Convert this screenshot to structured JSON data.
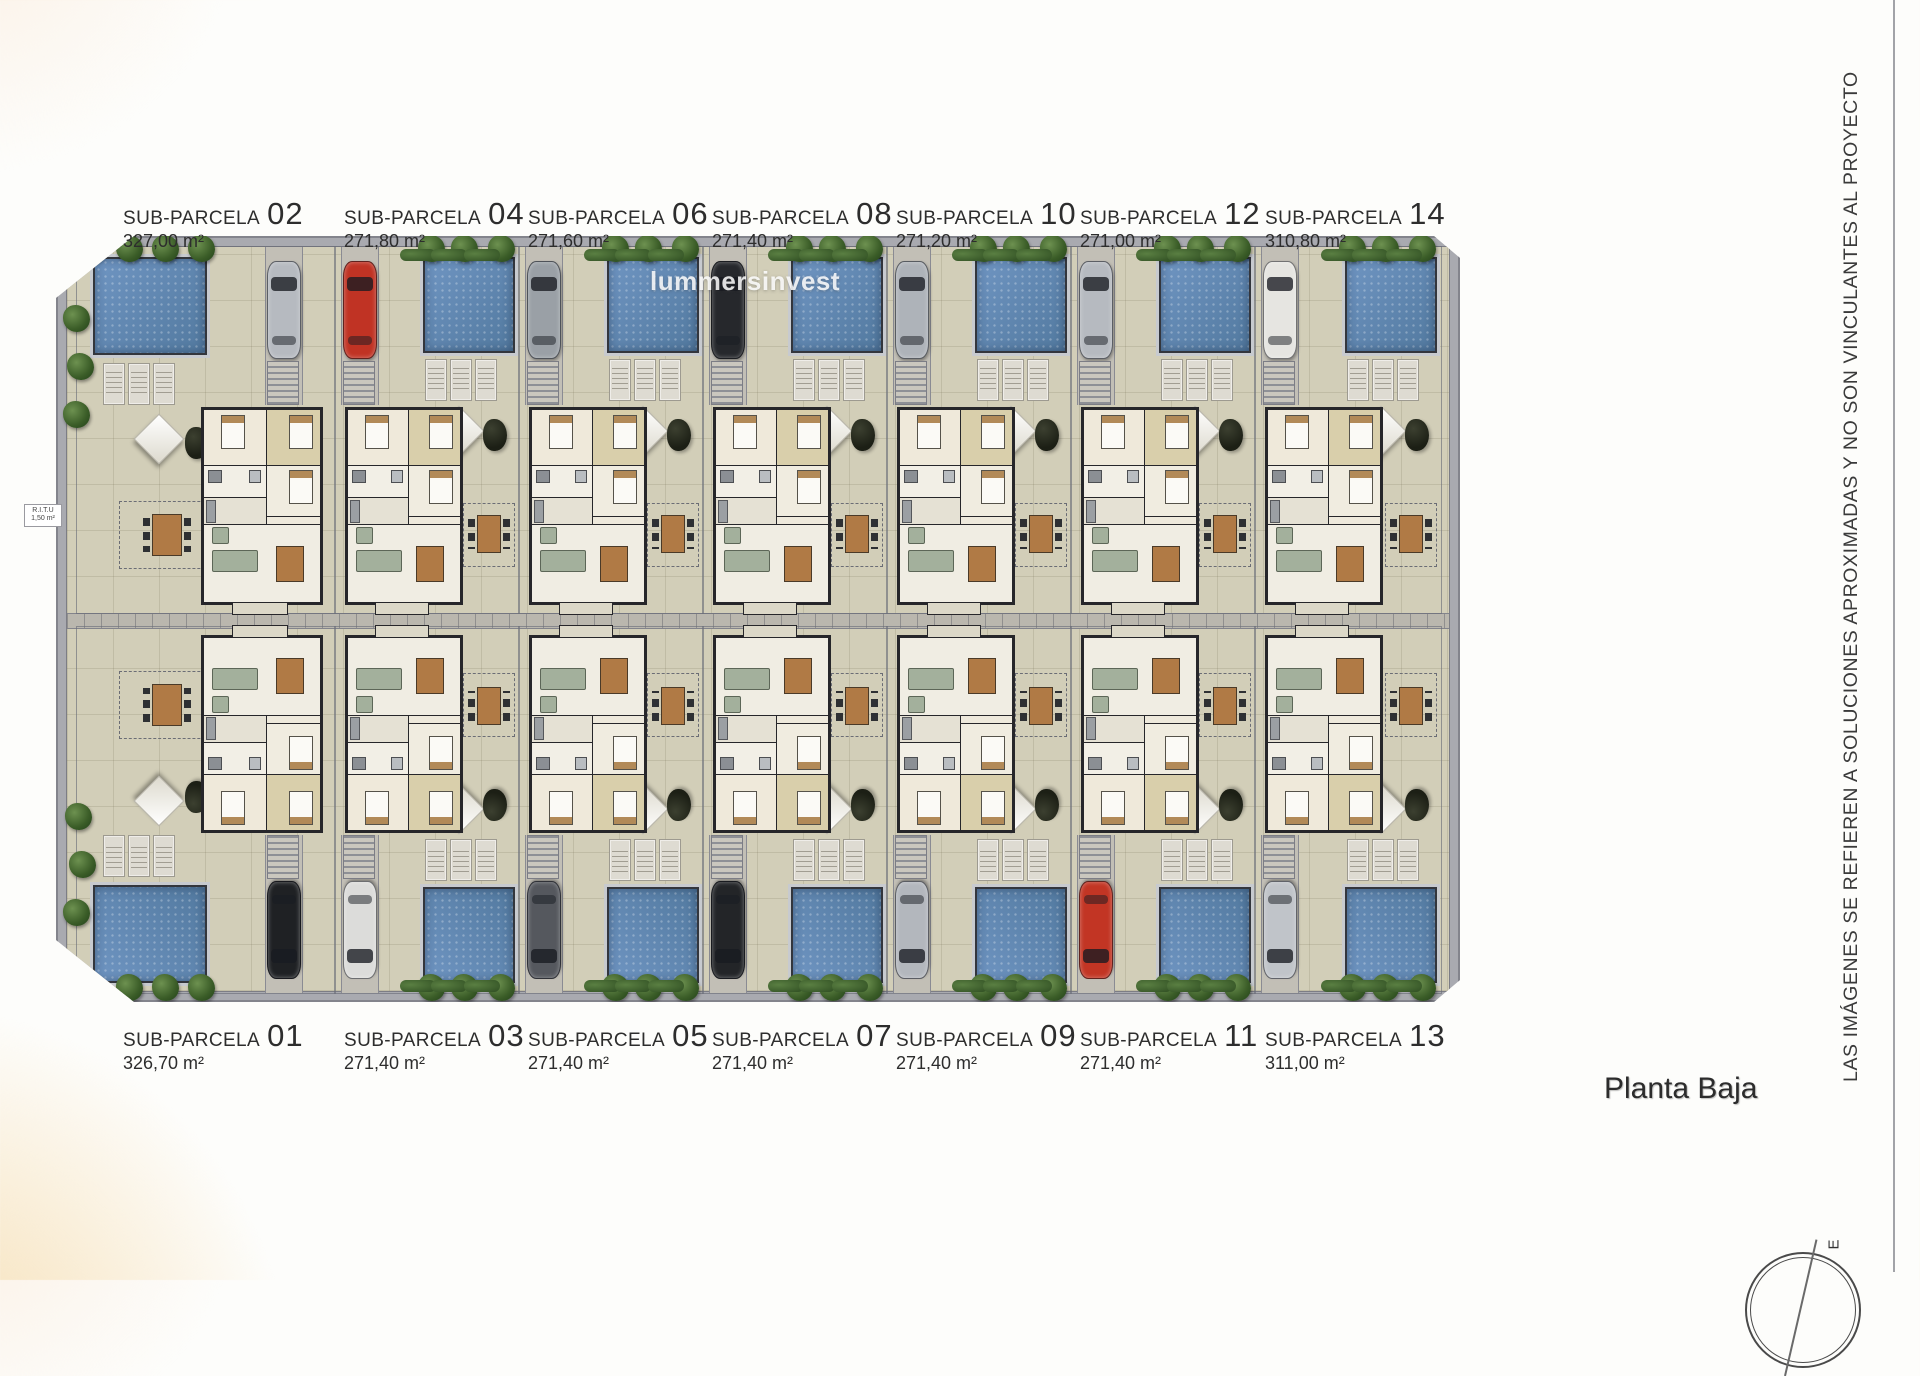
{
  "title": "Planta Baja",
  "watermark": "lummersinvest",
  "disclaimer": "LAS IMÁGENES SE REFIEREN A SOLUCIONES APROXIMADAS Y NO SON VINCULANTES AL PROYECTO",
  "compass": {
    "label": "E"
  },
  "ritu": {
    "line1": "R.I.T.U",
    "line2": "1,50 m²"
  },
  "colors": {
    "ground": "#d2ceb8",
    "road": "#a9aab0",
    "pool": "#5d85b4",
    "tree": "#3a5c27",
    "wall": "#26262a"
  },
  "parcels": {
    "top": [
      {
        "label": "SUB-PARCELA",
        "number": "02",
        "area": "327,00 m²",
        "car_color": "#b6bac0",
        "pool_side": "left"
      },
      {
        "label": "SUB-PARCELA",
        "number": "04",
        "area": "271,80 m²",
        "car_color": "#c03324",
        "pool_side": "right"
      },
      {
        "label": "SUB-PARCELA",
        "number": "06",
        "area": "271,60 m²",
        "car_color": "#9aa0a6",
        "pool_side": "right"
      },
      {
        "label": "SUB-PARCELA",
        "number": "08",
        "area": "271,40 m²",
        "car_color": "#26282c",
        "pool_side": "right"
      },
      {
        "label": "SUB-PARCELA",
        "number": "10",
        "area": "271,20 m²",
        "car_color": "#aeb3b9",
        "pool_side": "right"
      },
      {
        "label": "SUB-PARCELA",
        "number": "12",
        "area": "271,00 m²",
        "car_color": "#b6bac0",
        "pool_side": "right"
      },
      {
        "label": "SUB-PARCELA",
        "number": "14",
        "area": "310,80 m²",
        "car_color": "#e6e5e1",
        "pool_side": "right"
      }
    ],
    "bottom": [
      {
        "label": "SUB-PARCELA",
        "number": "01",
        "area": "326,70 m²",
        "car_color": "#1f2124",
        "pool_side": "left"
      },
      {
        "label": "SUB-PARCELA",
        "number": "03",
        "area": "271,40 m²",
        "car_color": "#dcdcda",
        "pool_side": "right"
      },
      {
        "label": "SUB-PARCELA",
        "number": "05",
        "area": "271,40 m²",
        "car_color": "#55585e",
        "pool_side": "right"
      },
      {
        "label": "SUB-PARCELA",
        "number": "07",
        "area": "271,40 m²",
        "car_color": "#232528",
        "pool_side": "right"
      },
      {
        "label": "SUB-PARCELA",
        "number": "09",
        "area": "271,40 m²",
        "car_color": "#b3b7bd",
        "pool_side": "right"
      },
      {
        "label": "SUB-PARCELA",
        "number": "11",
        "area": "271,40 m²",
        "car_color": "#c23524",
        "pool_side": "right"
      },
      {
        "label": "SUB-PARCELA",
        "number": "13",
        "area": "311,00 m²",
        "car_color": "#c0c4c9",
        "pool_side": "right"
      }
    ]
  }
}
